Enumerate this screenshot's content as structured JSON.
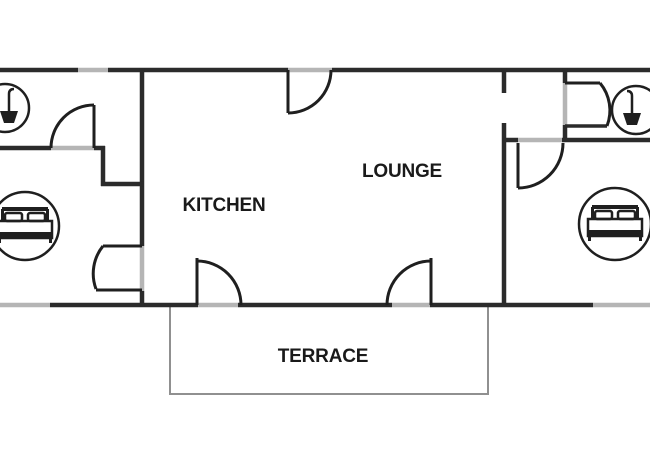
{
  "floor_plan": {
    "rooms": {
      "kitchen": {
        "label": "KITCHEN"
      },
      "lounge": {
        "label": "LOUNGE"
      },
      "terrace": {
        "label": "TERRACE"
      }
    },
    "icons": {
      "left_bathroom": "shower-icon",
      "right_bathroom": "shower-icon",
      "left_bedroom": "double-bed-icon",
      "right_bedroom": "double-bed-icon"
    },
    "colors": {
      "wall": "#2b2b2b",
      "door": "#1f1f1f",
      "opening": "#b5b5b5",
      "terrace_outline": "#909090",
      "text": "#1a1a1a",
      "background": "#ffffff"
    }
  }
}
